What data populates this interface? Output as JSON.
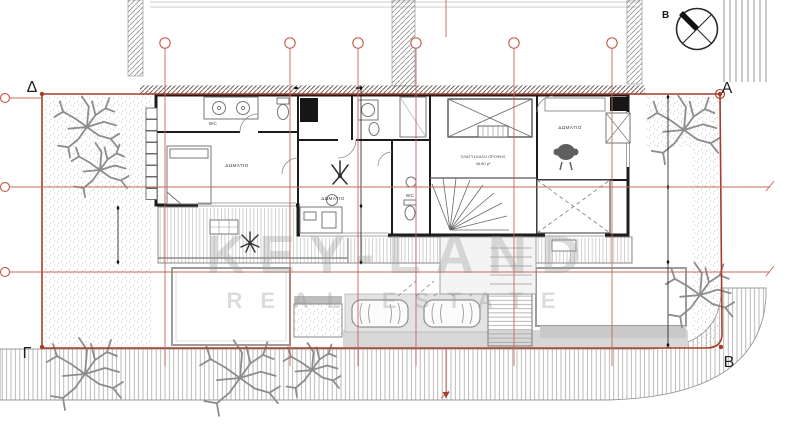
{
  "meta": {
    "drawing_type": "architectural floor plan (roof/upper level site plan)",
    "language": "Greek"
  },
  "corners": {
    "top_left": "Δ",
    "top_right": "A",
    "bottom_left": "Γ",
    "bottom_right": "B"
  },
  "compass": {
    "label": "B"
  },
  "labels": {
    "bedroom_left": "ΔΩΜΑΤΙΟ",
    "bedroom_middle": "ΔΩΜΑΤΙΟ",
    "bedroom_right": "ΔΩΜΑΤΙΟ",
    "wc_left": "WC",
    "wc_middle": "WC",
    "landing_line1": "ΠΛΑΤΥΣΚΑΛΟ ΟΡΟΦΗΣ",
    "landing_line2": "46.80 μ²"
  },
  "watermark": {
    "line1": "KEY-LAND",
    "line2": "REAL ESTATE"
  },
  "icons": {
    "compass": "compass-north-icon",
    "tree": "tree-icon",
    "car": "car-icon",
    "plant": "plant-icon",
    "armchair": "armchair-icon"
  },
  "colors": {
    "axis_red": "#c4685a",
    "boundary_red": "#a83b29",
    "wall_black": "#1c1c1c",
    "line_gray": "#8c8c8c",
    "fill_gray": "#d6d6d6",
    "stipple_gray": "#a0a0a0",
    "watermark_gray": "#9a9a9a"
  }
}
